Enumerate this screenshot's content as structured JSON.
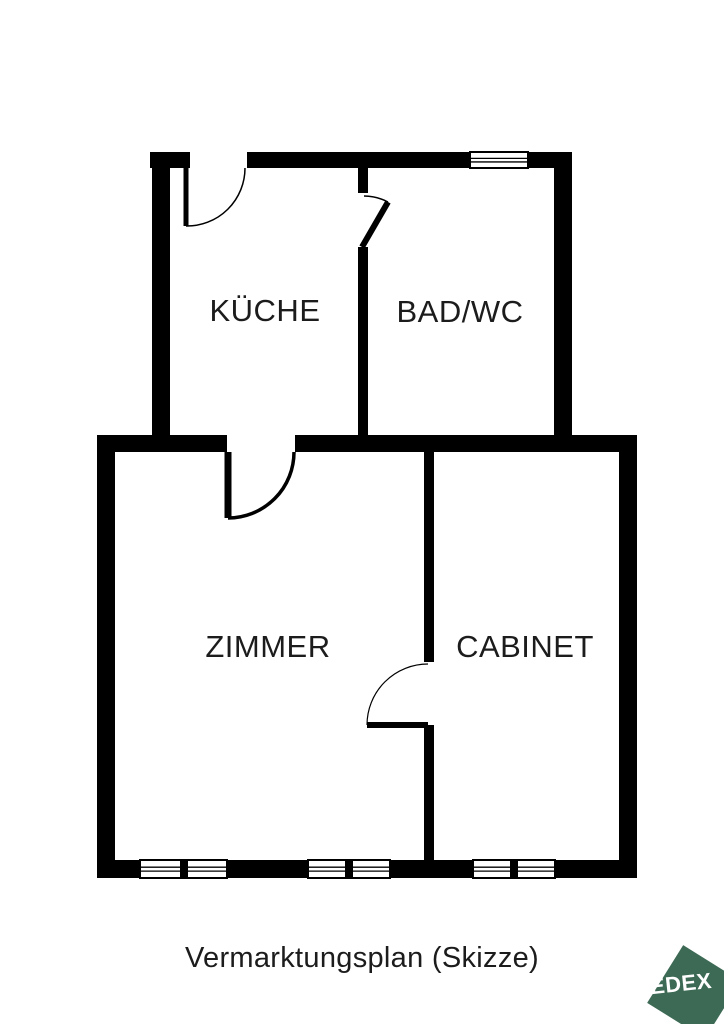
{
  "palette": {
    "wall": "#000000",
    "room_text": "#1c1c1c",
    "window_fill": "#ffffff"
  },
  "footer": {
    "caption": "Vermarktungsplan (Skizze)"
  },
  "logo": {
    "text": "EDEX",
    "square_color": "#3c6a54",
    "text_color": "#ffffff"
  },
  "floorplan": {
    "canvas": {
      "width": 724,
      "height": 1024
    },
    "rooms": [
      {
        "id": "kueche",
        "label": "KÜCHE",
        "label_x": 265,
        "label_y": 321
      },
      {
        "id": "bad-wc",
        "label": "BAD/WC",
        "label_x": 460,
        "label_y": 322
      },
      {
        "id": "zimmer",
        "label": "ZIMMER",
        "label_x": 268,
        "label_y": 657
      },
      {
        "id": "cabinet",
        "label": "CABINET",
        "label_x": 525,
        "label_y": 657
      }
    ],
    "walls": [
      {
        "x": 150,
        "y": 152,
        "w": 40,
        "h": 16
      },
      {
        "x": 247,
        "y": 152,
        "w": 223,
        "h": 16
      },
      {
        "x": 528,
        "y": 152,
        "w": 44,
        "h": 16
      },
      {
        "x": 152,
        "y": 152,
        "w": 18,
        "h": 300
      },
      {
        "x": 554,
        "y": 152,
        "w": 18,
        "h": 300
      },
      {
        "x": 358,
        "y": 166,
        "w": 10,
        "h": 27
      },
      {
        "x": 358,
        "y": 247,
        "w": 10,
        "h": 198
      },
      {
        "x": 97,
        "y": 435,
        "w": 130,
        "h": 17
      },
      {
        "x": 295,
        "y": 435,
        "w": 342,
        "h": 17
      },
      {
        "x": 97,
        "y": 435,
        "w": 18,
        "h": 443
      },
      {
        "x": 619,
        "y": 435,
        "w": 18,
        "h": 443
      },
      {
        "x": 97,
        "y": 860,
        "w": 43,
        "h": 18
      },
      {
        "x": 227,
        "y": 860,
        "w": 81,
        "h": 18
      },
      {
        "x": 390,
        "y": 860,
        "w": 83,
        "h": 18
      },
      {
        "x": 555,
        "y": 860,
        "w": 82,
        "h": 18
      },
      {
        "x": 424,
        "y": 452,
        "w": 10,
        "h": 210
      },
      {
        "x": 424,
        "y": 725,
        "w": 10,
        "h": 135
      }
    ],
    "windows": [
      {
        "x": 470,
        "y": 152,
        "w": 58,
        "h": 16,
        "mullions": []
      },
      {
        "x": 140,
        "y": 860,
        "w": 87,
        "h": 18,
        "mullions": [
          180
        ]
      },
      {
        "x": 308,
        "y": 860,
        "w": 82,
        "h": 18,
        "mullions": [
          345
        ]
      },
      {
        "x": 473,
        "y": 860,
        "w": 82,
        "h": 18,
        "mullions": [
          510
        ]
      }
    ],
    "doors": [
      {
        "id": "entry-door",
        "hinge": [
          186,
          168
        ],
        "leaf_end": [
          186,
          226
        ],
        "arc_end": [
          245,
          168
        ],
        "sweep": 0,
        "leaf_w": 5,
        "arc_w": 1.5
      },
      {
        "id": "bad-wc-door",
        "hinge": [
          362,
          247
        ],
        "leaf_end": [
          388,
          202
        ],
        "arc_end": [
          364,
          196
        ],
        "sweep": 0,
        "leaf_w": 6,
        "arc_w": 1.5
      },
      {
        "id": "zimmer-door",
        "hinge": [
          228,
          452
        ],
        "leaf_end": [
          228,
          518
        ],
        "arc_end": [
          294,
          452
        ],
        "sweep": 0,
        "leaf_w": 7,
        "arc_w": 3.5
      },
      {
        "id": "cabinet-door",
        "hinge": [
          428,
          725
        ],
        "leaf_end": [
          367,
          725
        ],
        "arc_end": [
          428,
          664
        ],
        "sweep": 1,
        "leaf_w": 6,
        "arc_w": 1.2
      }
    ],
    "mullion_width": 8
  }
}
